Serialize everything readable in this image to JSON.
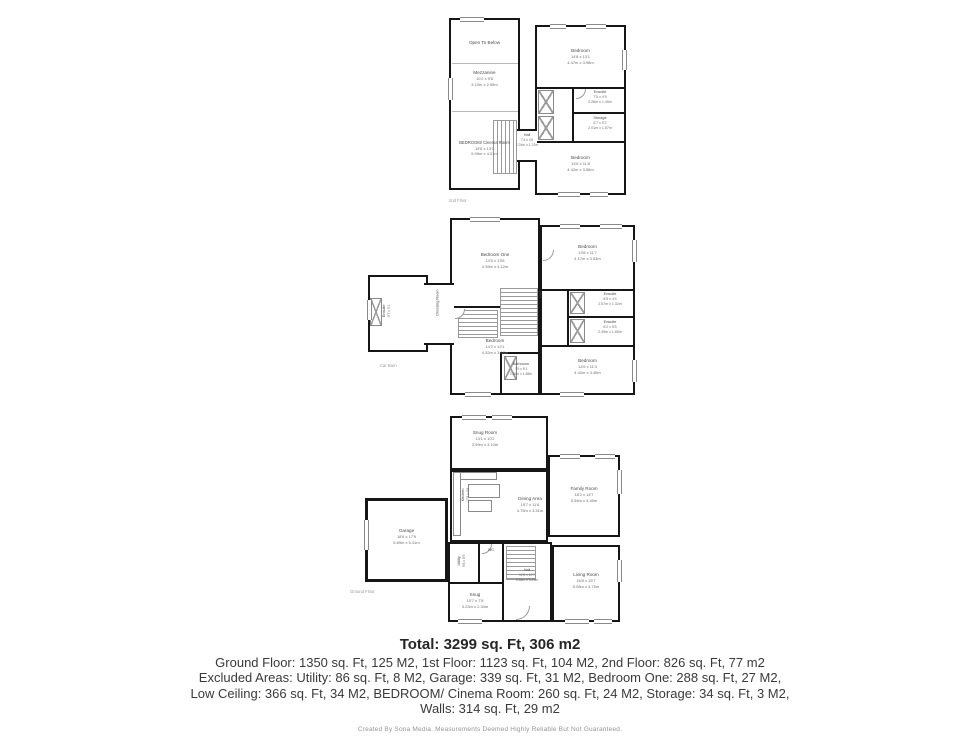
{
  "colors": {
    "background": "#ffffff",
    "wall": "#161616",
    "room_label": "#4a4a4a",
    "dimension_label": "#6f6f6f",
    "summary_text": "#3a3a3a",
    "credit_text": "#969696"
  },
  "summary": {
    "total": "Total: 3299 sq. Ft, 306 m2",
    "floors_line": "Ground Floor: 1350 sq. Ft, 125 M2, 1st Floor: 1123 sq. Ft, 104 M2, 2nd Floor: 826 sq. Ft, 77 m2",
    "excluded_line1": "Excluded Areas: Utility: 86 sq. Ft, 8 M2, Garage: 339 sq. Ft, 31 M2, Bedroom One: 288 sq. Ft, 27 M2,",
    "excluded_line2": "Low Ceiling: 366 sq. Ft, 34 M2, BEDROOM/ Cinema Room: 260 sq. Ft, 24 M2, Storage: 34 sq. Ft, 3 M2,",
    "excluded_line3": "Walls: 314 sq. Ft, 29 m2",
    "credit": "Created By Sona Media. Measurements Deemed Highly Reliable But Not Guaranteed."
  },
  "floors": {
    "second": {
      "label": "2nd Floor",
      "rooms": {
        "open_to_below": {
          "name": "Open To Below"
        },
        "mezzanine": {
          "name": "Mezzanine",
          "imp": "10'2 x 9'8",
          "met": "3.10m x 2.95m"
        },
        "cinema": {
          "name": "BEDROOM/ Cinema Room",
          "imp": "19'8 x 13'2",
          "met": "5.99m x 4.01m"
        },
        "bedroom_top": {
          "name": "Bedroom",
          "imp": "14'8 x 13'1",
          "met": "4.47m x 3.98m"
        },
        "ensuite": {
          "name": "Ensuite",
          "imp": "7'5 x 4'9",
          "met": "2.26m x 1.45m"
        },
        "storage": {
          "name": "Storage",
          "imp": "6'7 x 5'2",
          "met": "2.01m x 1.57m"
        },
        "bedroom_bottom": {
          "name": "Bedroom",
          "imp": "14'6 x 11'8",
          "met": "4.42m x 3.56m"
        },
        "hall": {
          "name": "Hall",
          "imp": "7'4 x 4'6",
          "met": "2.24m x 1.37m"
        }
      }
    },
    "first": {
      "annotation": "Car Barn",
      "rooms": {
        "bedroom_one": {
          "name": "Bedroom One",
          "imp": "14'5 x 13'6",
          "met": "4.39m x 4.12m"
        },
        "bedroom_mid": {
          "name": "Bedroom",
          "imp": "14'2 x 12'1",
          "met": "4.32m x 3.68m"
        },
        "bedroom_tr": {
          "name": "Bedroom",
          "imp": "13'8 x 11'7",
          "met": "4.17m x 3.53m"
        },
        "ensuite_a": {
          "name": "Ensuite",
          "imp": "8'5 x 4'4",
          "met": "2.57m x 1.32m"
        },
        "ensuite_b": {
          "name": "Ensuite",
          "imp": "8'2 x 5'5",
          "met": "2.49m x 1.65m"
        },
        "bedroom_br": {
          "name": "Bedroom",
          "imp": "14'6 x 11'4",
          "met": "4.42m x 3.45m"
        },
        "bathroom": {
          "name": "Bathroom",
          "imp": "7'9 x 6'1",
          "met": "2.36m x 1.85m"
        },
        "ensuite_wing": {
          "name": "Ensuite",
          "imp": "9'7 x 5'1",
          "met": "2.92m x 1.55m"
        },
        "dressing": {
          "name": "Dressing Room"
        },
        "hall": {
          "name": "Hall"
        }
      }
    },
    "ground": {
      "label": "Ground Floor",
      "rooms": {
        "snug_room": {
          "name": "Snug Room",
          "imp": "13'1 x 10'2",
          "met": "3.99m x 3.10m"
        },
        "kitchen": {
          "name": "Kitchen",
          "imp": "17'4 x 8'8",
          "met": "5.28m x 2.64m"
        },
        "dining": {
          "name": "Dining Area",
          "imp": "15'7 x 11'6",
          "met": "4.75m x 3.51m"
        },
        "family": {
          "name": "Family Room",
          "imp": "18'2 x 14'7",
          "met": "5.54m x 4.45m"
        },
        "garage": {
          "name": "Garage",
          "imp": "18'8 x 17'9",
          "met": "5.69m x 5.41m"
        },
        "utility": {
          "name": "Utility",
          "imp": "9'8 x 8'9",
          "met": "2.95m x 2.67m"
        },
        "wc": {
          "name": "WC"
        },
        "hall": {
          "name": "Hall",
          "imp": "11'8 x 10'7",
          "met": "3.56m x 3.23m"
        },
        "living": {
          "name": "Living Room",
          "imp": "16'8 x 15'7",
          "met": "5.08m x 4.75m"
        },
        "snug": {
          "name": "Snug",
          "imp": "10'7 x 7'8",
          "met": "3.23m x 2.34m"
        }
      }
    }
  }
}
